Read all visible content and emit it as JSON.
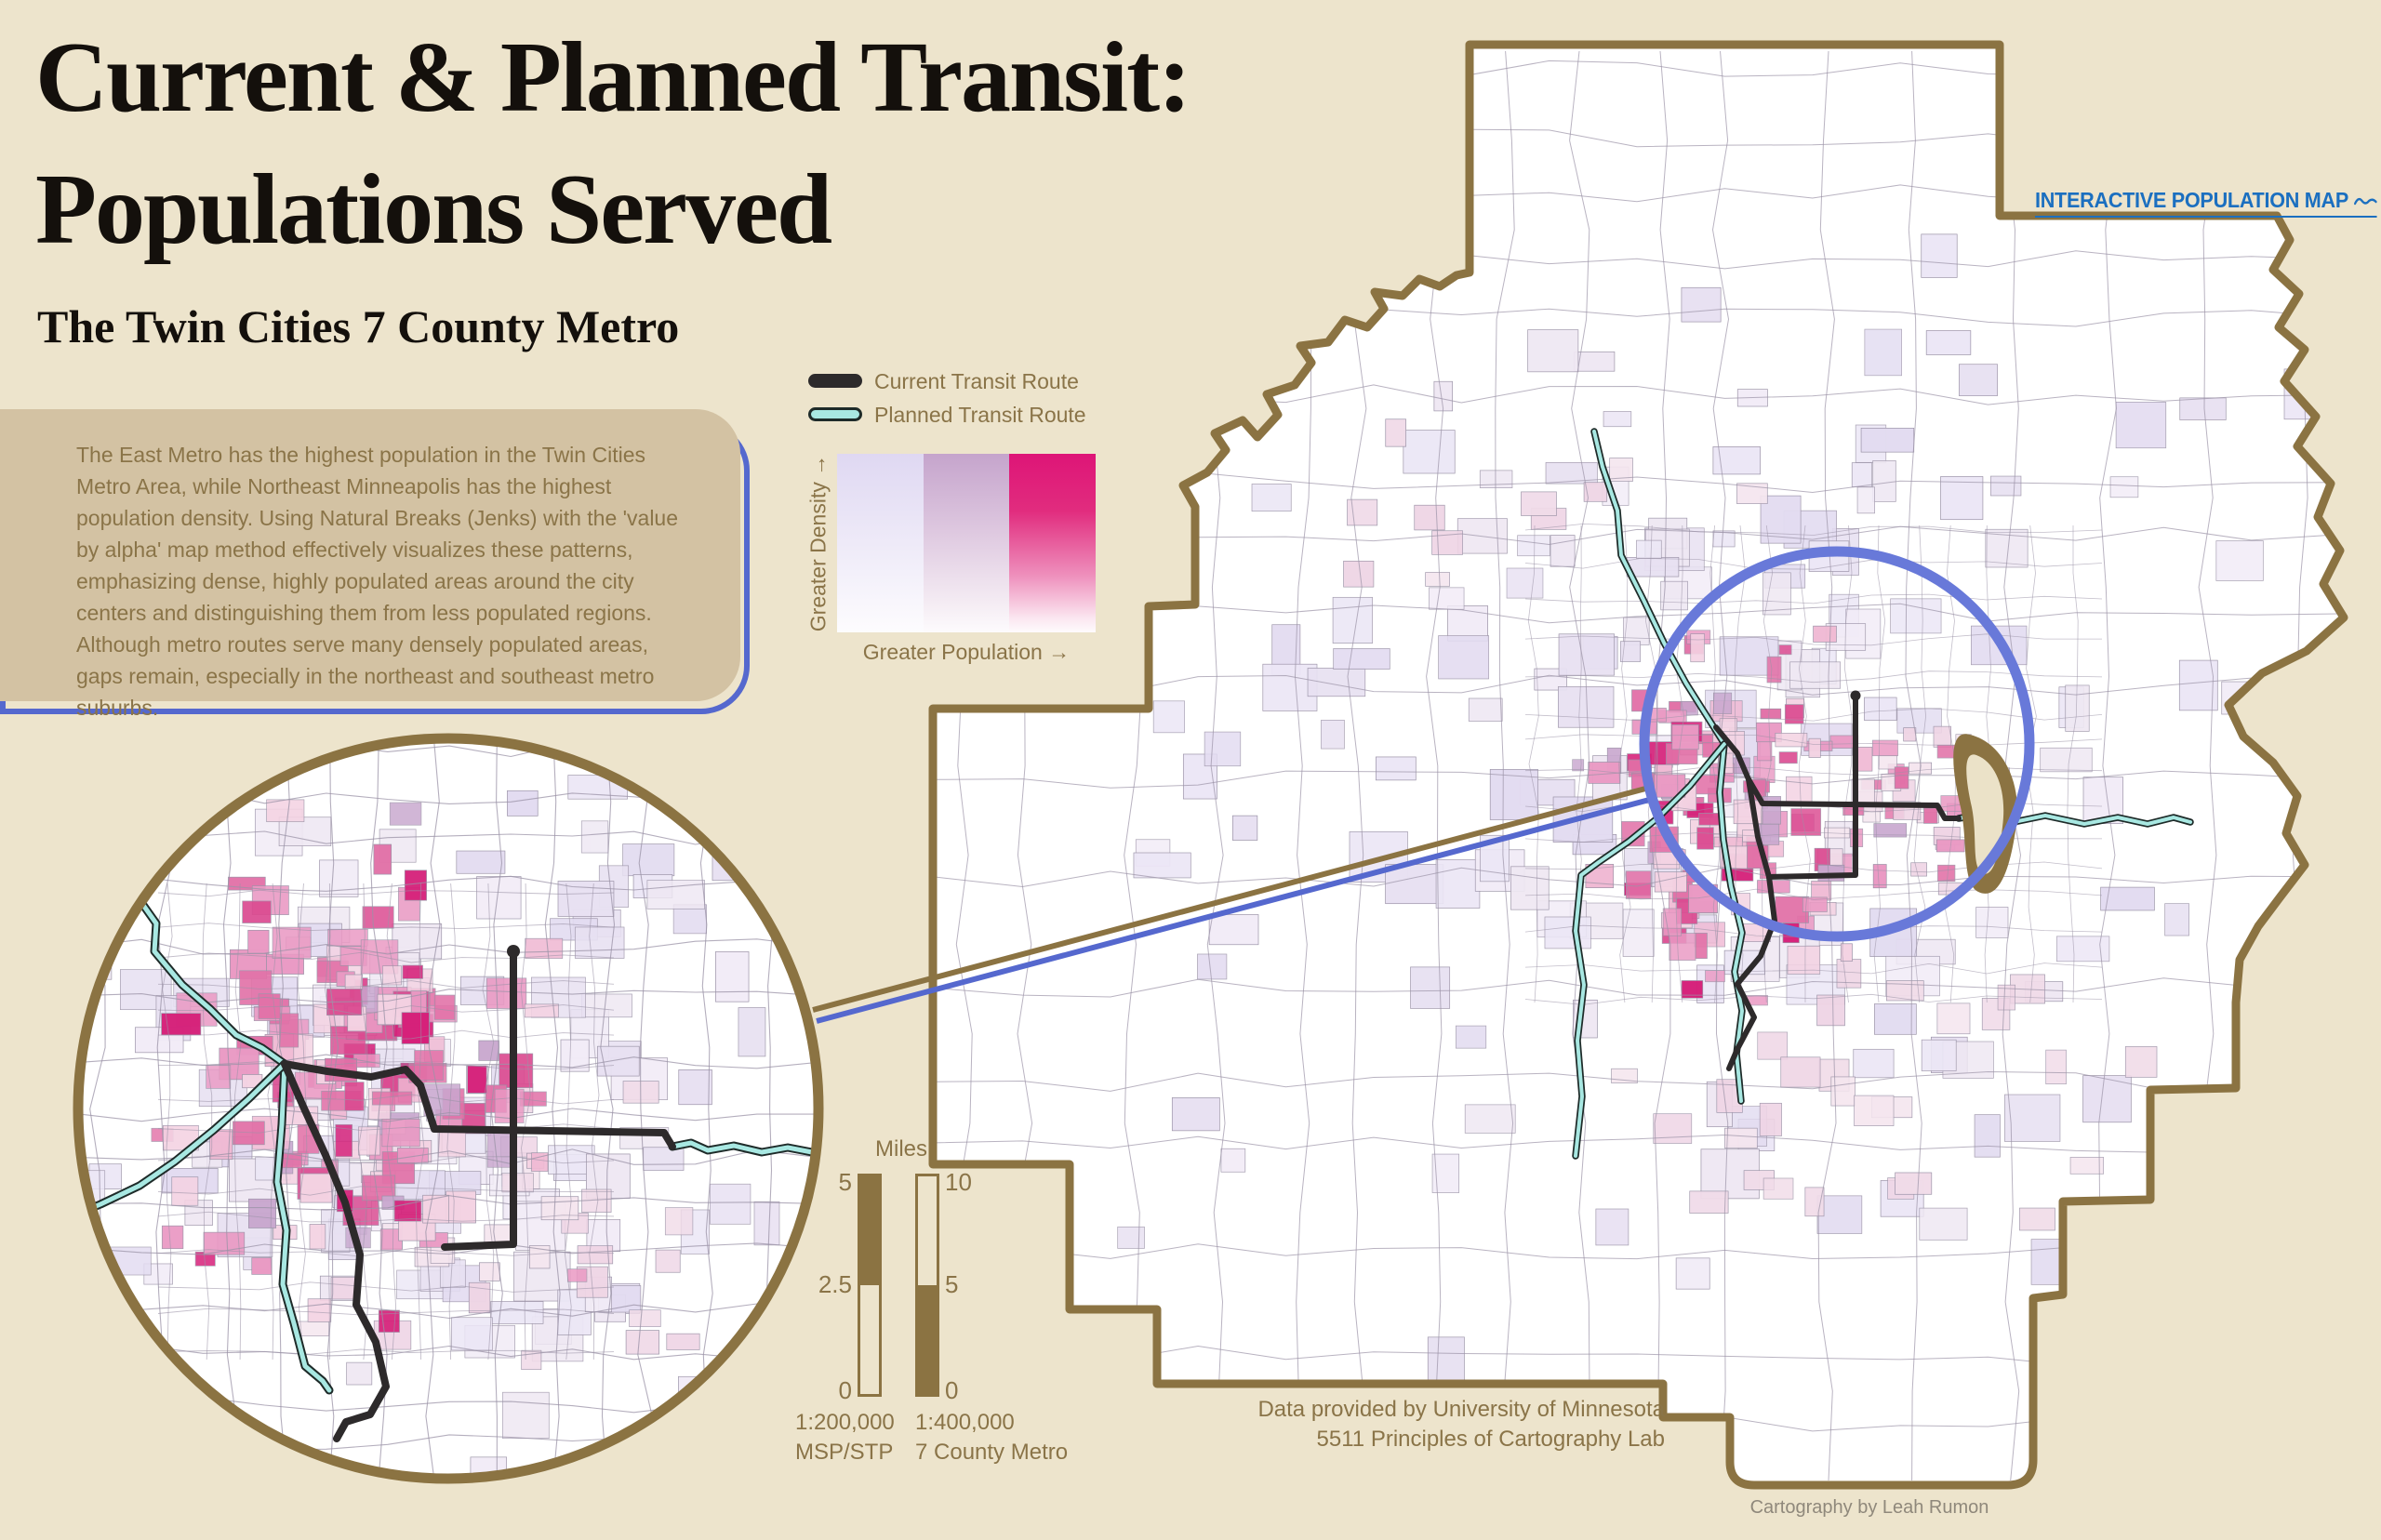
{
  "header": {
    "title_line1": "Current & Planned Transit:",
    "title_line2": "Populations Served",
    "subtitle": "The Twin Cities 7 County Metro"
  },
  "description": "The East Metro has the highest population in the Twin Cities Metro Area, while Northeast Minneapolis has the highest population density. Using Natural Breaks (Jenks) with the 'value by alpha' map method effectively visualizes these patterns, emphasizing dense, highly populated areas around the city centers and distinguishing them from less populated regions. Although metro routes serve many densely populated areas, gaps remain, especially in the northeast and southeast metro suburbs.",
  "legend": {
    "current_label": "Current Transit Route",
    "planned_label": "Planned Transit Route",
    "density_label": "Greater Density →",
    "population_label": "Greater Population →"
  },
  "link": {
    "label": "INTERACTIVE POPULATION MAP"
  },
  "scale": {
    "title": "Miles",
    "left": {
      "top_value": "5",
      "mid_value": "2.5",
      "bottom_value": "0",
      "ratio": "1:200,000",
      "area": "MSP/STP"
    },
    "right": {
      "top_value": "10",
      "mid_value": "5",
      "bottom_value": "0",
      "ratio": "1:400,000",
      "area": "7 County Metro"
    }
  },
  "attribution": {
    "line1": "Data provided by University of Minnesota",
    "line2": "5511 Principles of Cartography Lab",
    "credit": "Cartography by Leah Rumon"
  },
  "colors": {
    "background": "#EDE4CC",
    "panel": "#D3C2A3",
    "ink": "#8A7448",
    "border": "#8B7342",
    "accent": "#5568CE",
    "circle": "#6879D9",
    "link": "#1B6FC0",
    "route_current": "#2D2A2B",
    "route_planned": "#A8E8E2",
    "g_low": "#DFD8F2",
    "g_mid": "#C5A4CC",
    "g_high": "#DE1577",
    "credit": "#8F887B",
    "tract": "#9B93A7"
  }
}
